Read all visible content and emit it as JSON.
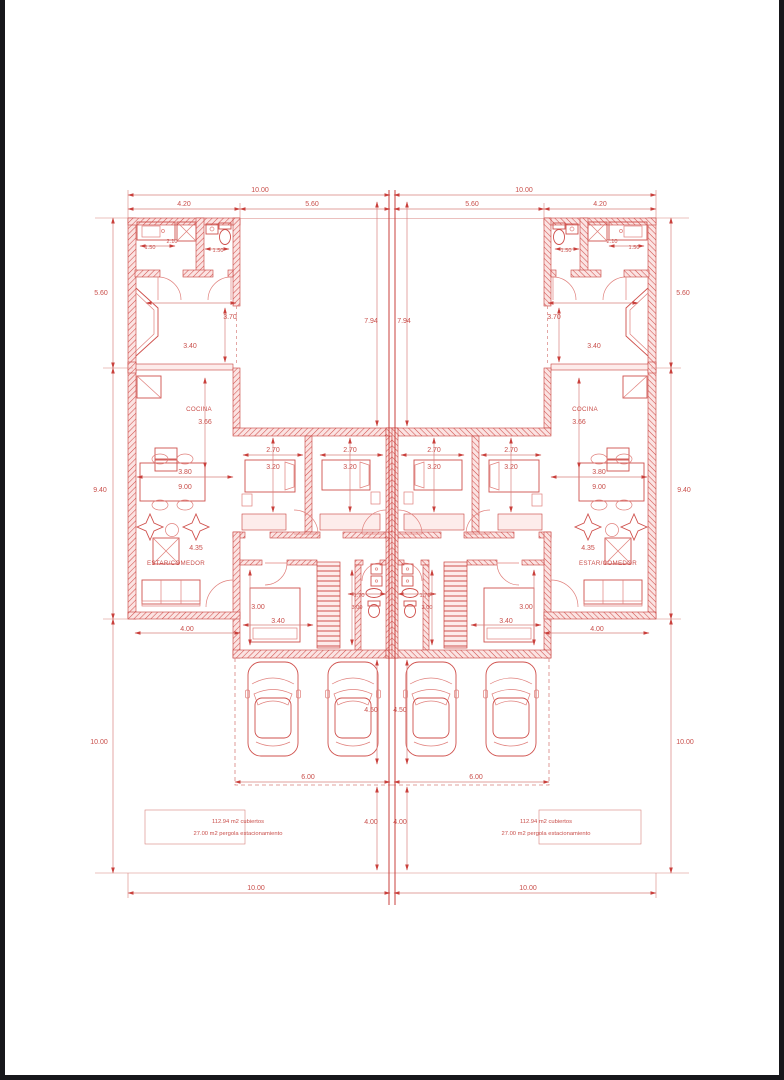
{
  "colors": {
    "line": "#c9403c",
    "dim": "#d8827e",
    "txt": "#c94f4b",
    "wallfill": "#fbe3e2",
    "winfill": "#fdeceb",
    "frame": "#17171b",
    "paper": "#ffffff"
  },
  "labels": {
    "cocina": "COCINA",
    "estar_comedor": "ESTAR/COMEDOR",
    "area_cubiertos": "112.94 m2 cubiertos",
    "area_pergola": "27.00 m2 pergola estacionamiento"
  },
  "dims": {
    "total_width": "10.00",
    "wing_width": "4.20",
    "court_width": "5.60",
    "side_top": "5.60",
    "side_mid": "9.40",
    "side_bottom": "10.00",
    "court_depth": "7.94",
    "bath_sink": "1.50",
    "bath_width": "2.10",
    "bath_wc": "1.50",
    "hall_width": "3.40",
    "hall_depth": "3.70",
    "kitchen_depth": "3.66",
    "dining_width": "3.80",
    "dining_depth": "9.00",
    "living_depth": "4.35",
    "living_width": "4.00",
    "bed_width": "2.70",
    "bed_depth": "3.20",
    "bed3_depth": "3.00",
    "bed3_width": "3.40",
    "bath2_width": "1.70",
    "bath2_depth": "3.00",
    "car_depth": "4.50",
    "park_width": "6.00",
    "park_depth": "4.00",
    "bottom_width": "10.00"
  }
}
